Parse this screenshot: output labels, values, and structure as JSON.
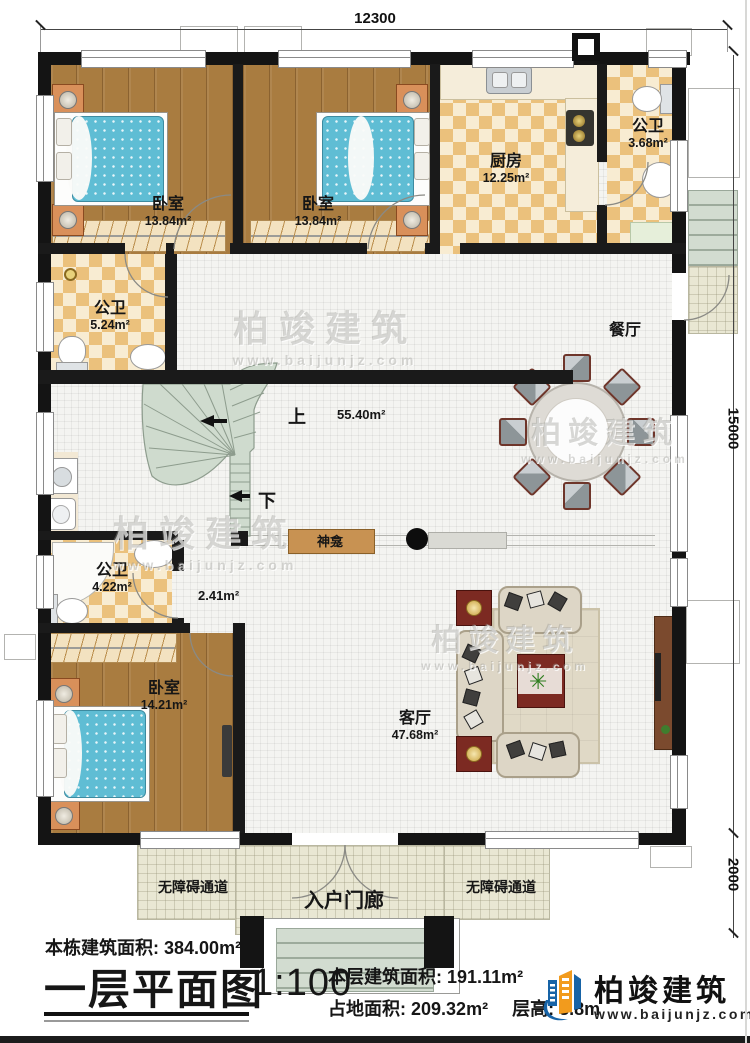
{
  "dimensions": {
    "width_top": "12300",
    "height_right": "15000",
    "porch_depth": "2000"
  },
  "rooms": {
    "bedroom1": {
      "name": "卧室",
      "area": "13.84m²"
    },
    "bedroom2": {
      "name": "卧室",
      "area": "13.84m²"
    },
    "bedroom3": {
      "name": "卧室",
      "area": "14.21m²"
    },
    "kitchen": {
      "name": "厨房",
      "area": "12.25m²"
    },
    "bath_top": {
      "name": "公卫",
      "area": "3.68m²"
    },
    "bath_mid": {
      "name": "公卫",
      "area": "5.24m²"
    },
    "bath_low": {
      "name": "公卫",
      "area": "4.22m²"
    },
    "dining": {
      "name": "餐厅"
    },
    "living": {
      "name": "客厅",
      "area": "47.68m²"
    },
    "hall": {
      "area": "55.40m²"
    },
    "corridor": {
      "area": "2.41m²"
    }
  },
  "plan_labels": {
    "up": "上",
    "down": "下",
    "shrine": "神龛",
    "porch": "入户门廊",
    "ramp_left": "无障碍通道",
    "ramp_right": "无障碍通道"
  },
  "title_block": {
    "building_area_label": "本栋建筑面积:",
    "building_area_value": "384.00m²",
    "plan_title": "一层平面图",
    "scale": "1:100",
    "floor_area_label": "本层建筑面积:",
    "floor_area_value": "191.11m²",
    "site_area_label": "占地面积:",
    "site_area_value": "209.32m²",
    "floor_height_label": "层高:",
    "floor_height_value": "3.8m"
  },
  "brand": {
    "name": "柏竣建筑",
    "website": "www.baijunjz.com"
  },
  "watermark": {
    "line1": "柏竣建筑",
    "line2": "www.baijunjz.com"
  },
  "colors": {
    "wall": "#141414",
    "tile_dark": "#ebc17c",
    "tile_light": "#f8ecd2",
    "wood": "#a97c40",
    "stairs": "#cfdbce",
    "accent_red": "#7c2a22",
    "brand_blue": "#1763a6",
    "brand_orange": "#f29b1d"
  }
}
